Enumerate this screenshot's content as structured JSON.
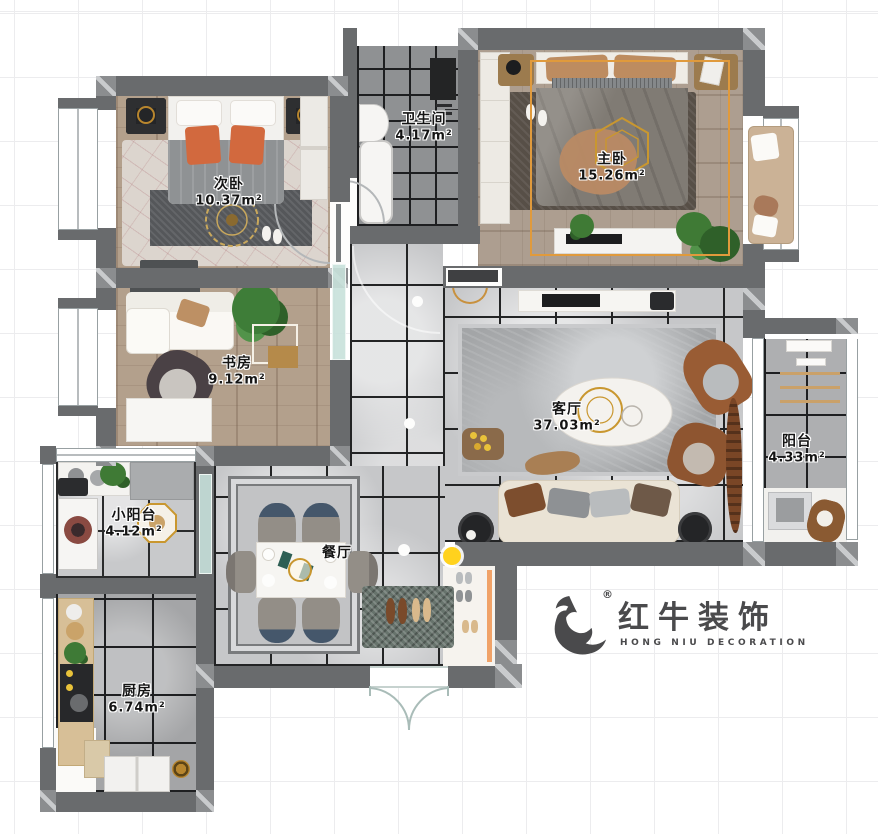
{
  "rooms": {
    "second_bedroom": {
      "name": "次卧",
      "area": "10.37m²"
    },
    "bathroom": {
      "name": "卫生间",
      "area": "4.17m²"
    },
    "master_bedroom": {
      "name": "主卧",
      "area": "15.26m²"
    },
    "study": {
      "name": "书房",
      "area": "9.12m²"
    },
    "living_room": {
      "name": "客厅",
      "area": "37.03m²"
    },
    "balcony": {
      "name": "阳台",
      "area": "4.33m²"
    },
    "small_balcony": {
      "name": "小阳台",
      "area": "4.12m²"
    },
    "dining_room": {
      "name": "餐厅",
      "area": ""
    },
    "kitchen": {
      "name": "厨房",
      "area": "6.74m²"
    }
  },
  "logo": {
    "cn": "红牛装饰",
    "en": "HONG NIU DECORATION",
    "registered_mark": "®"
  },
  "colors": {
    "wall": "#696b6d",
    "highlight_outline": "#e09a3c",
    "highlight_dot": "#ffd21e",
    "logo": "#4a4a4c"
  }
}
